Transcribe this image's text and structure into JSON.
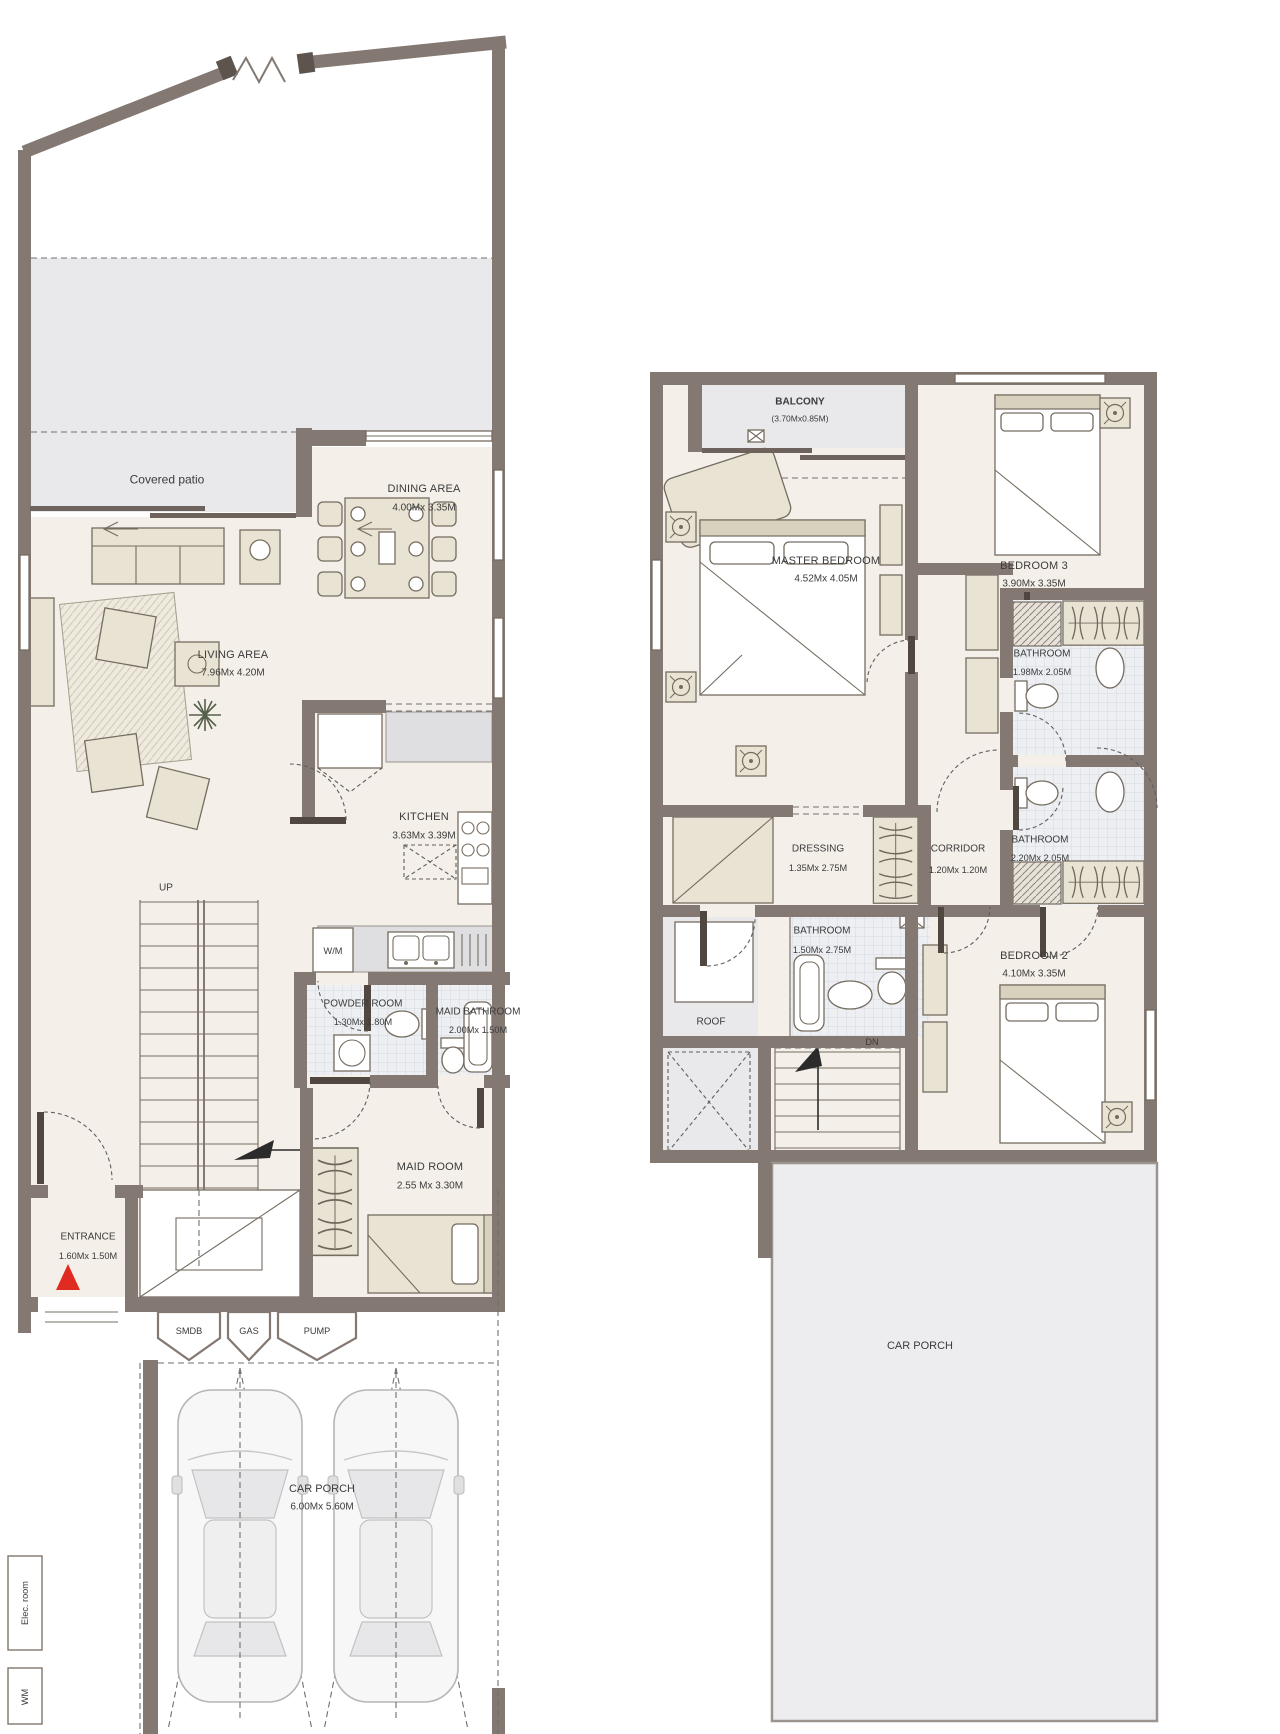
{
  "ground_floor": {
    "patio": {
      "name": "Covered patio"
    },
    "dining": {
      "name": "DINING AREA",
      "dims": "4.00Mx 3.35M"
    },
    "living": {
      "name": "LIVING AREA",
      "dims": "7.96Mx 4.20M"
    },
    "kitchen": {
      "name": "KITCHEN",
      "dims": "3.63Mx 3.39M"
    },
    "washing_machine": {
      "name": "W/M"
    },
    "stairs": {
      "name": "UP"
    },
    "powder": {
      "name": "POWDER ROOM",
      "dims": "1.30Mx 1.80M"
    },
    "maid_bathroom": {
      "name": "MAID BATHROOM",
      "dims": "2.00Mx 1.50M"
    },
    "maid_room": {
      "name": "MAID ROOM",
      "dims": "2.55 Mx 3.30M"
    },
    "entrance": {
      "name": "ENTRANCE",
      "dims": "1.60Mx 1.50M"
    },
    "smdb": {
      "name": "SMDB"
    },
    "gas": {
      "name": "GAS"
    },
    "pump": {
      "name": "PUMP"
    },
    "car_porch": {
      "name": "CAR PORCH",
      "dims": "6.00Mx 5.60M"
    },
    "elec_room": {
      "name": "Elec. room"
    },
    "wm_box": {
      "name": "WM"
    }
  },
  "first_floor": {
    "balcony": {
      "name": "BALCONY",
      "dims": "(3.70Mx0.85M)"
    },
    "master_bedroom": {
      "name": "MASTER BEDROOM",
      "dims": "4.52Mx 4.05M"
    },
    "bedroom3": {
      "name": "BEDROOM 3",
      "dims": "3.90Mx 3.35M"
    },
    "bathroom3": {
      "name": "BATHROOM",
      "dims": "1.98Mx 2.05M"
    },
    "dressing": {
      "name": "DRESSING",
      "dims": "1.35Mx 2.75M"
    },
    "corridor": {
      "name": "CORRIDOR",
      "dims": "1.20Mx 1.20M"
    },
    "master_bathroom": {
      "name": "BATHROOM",
      "dims": "1.50Mx 2.75M"
    },
    "bathroom2": {
      "name": "BATHROOM",
      "dims": "2.20Mx 2.05M"
    },
    "bedroom2": {
      "name": "BEDROOM 2",
      "dims": "4.10Mx 3.35M"
    },
    "stairs": {
      "name": "DN"
    },
    "roof": {
      "name": "ROOF"
    },
    "car_porch": {
      "name": "CAR PORCH"
    }
  },
  "colors": {
    "wall": "#847872",
    "floor": "#f4efe8",
    "shaded_area": "#e9e9eb",
    "furniture": "#e9e3d3",
    "entrance_marker_red": "#e02b20"
  }
}
